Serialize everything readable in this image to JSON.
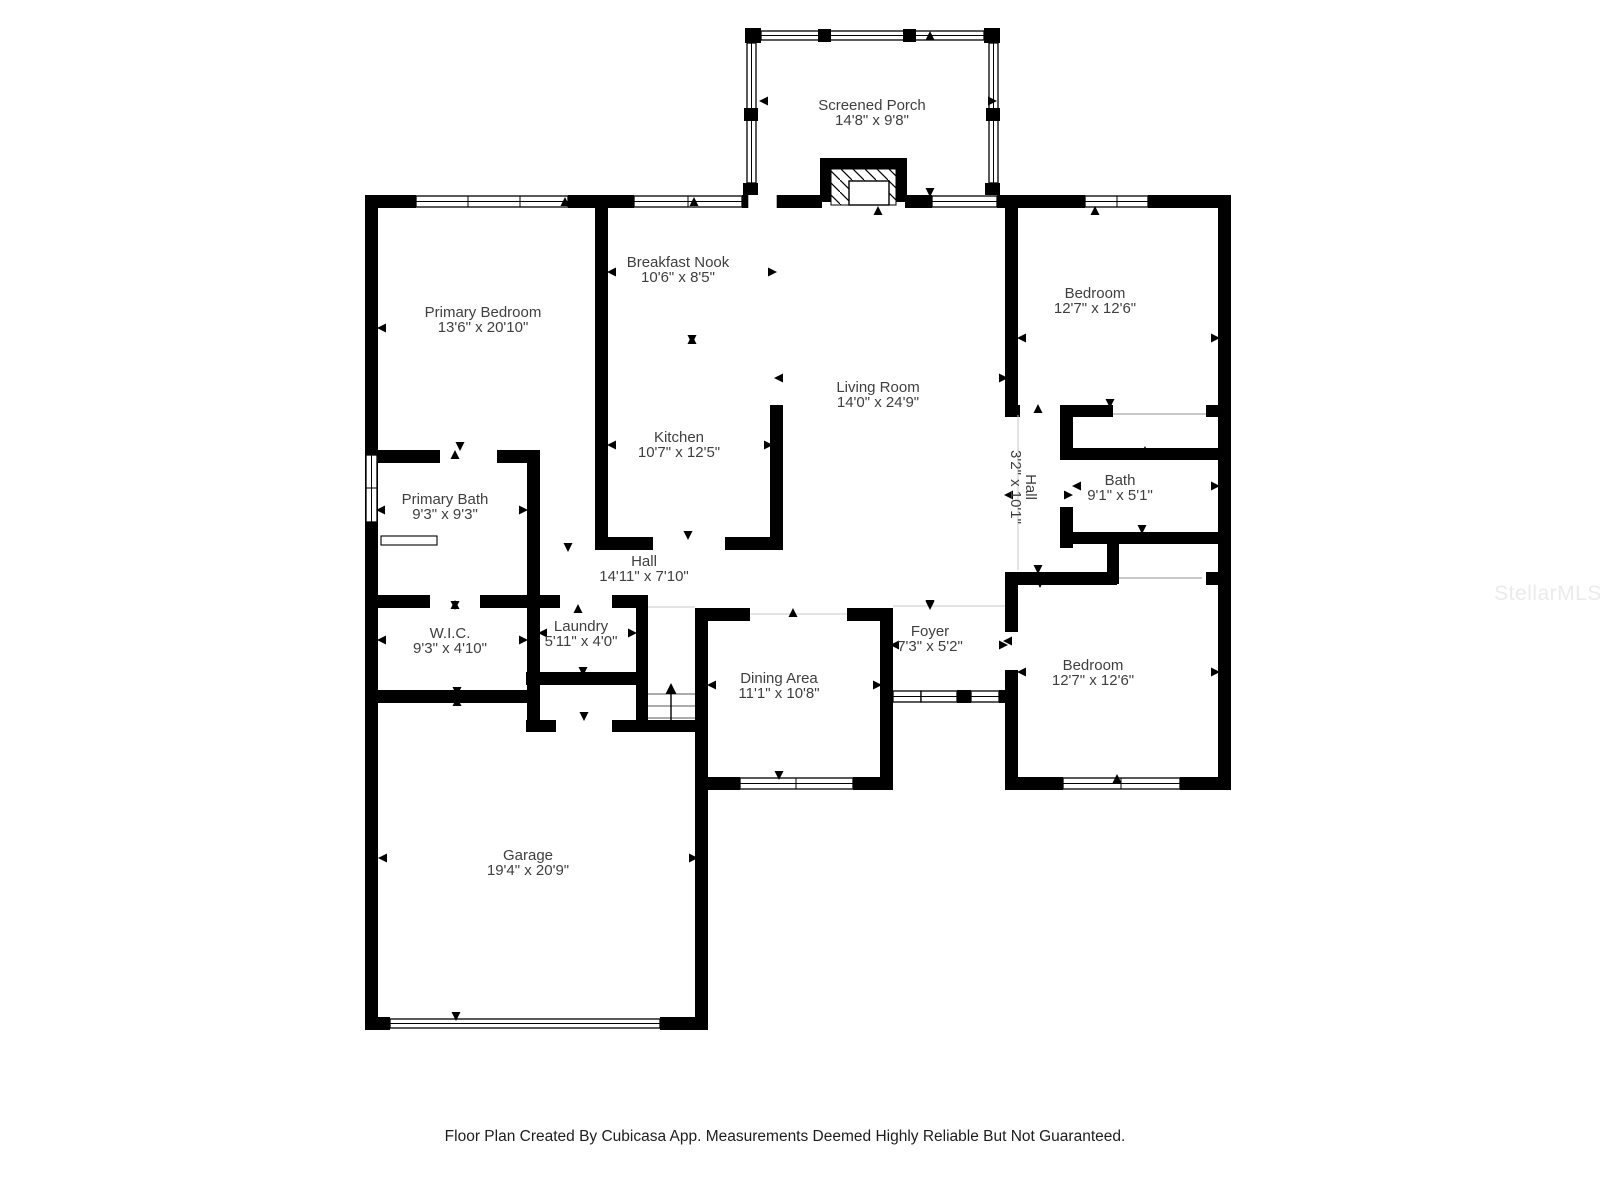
{
  "plan": {
    "rooms": [
      {
        "id": "screened-porch",
        "name": "Screened Porch",
        "dims": "14'8\" x 9'8\""
      },
      {
        "id": "primary-bedroom",
        "name": "Primary Bedroom",
        "dims": "13'6\" x 20'10\""
      },
      {
        "id": "breakfast-nook",
        "name": "Breakfast Nook",
        "dims": "10'6\" x 8'5\""
      },
      {
        "id": "living-room",
        "name": "Living Room",
        "dims": "14'0\" x 24'9\""
      },
      {
        "id": "bedroom-top",
        "name": "Bedroom",
        "dims": "12'7\" x 12'6\""
      },
      {
        "id": "kitchen",
        "name": "Kitchen",
        "dims": "10'7\" x 12'5\""
      },
      {
        "id": "primary-bath",
        "name": "Primary Bath",
        "dims": "9'3\" x 9'3\""
      },
      {
        "id": "hall-vertical",
        "name": "Hall",
        "dims": "3'2\" x 10'1\""
      },
      {
        "id": "bath",
        "name": "Bath",
        "dims": "9'1\" x 5'1\""
      },
      {
        "id": "hall-horizontal",
        "name": "Hall",
        "dims": "14'11\" x 7'10\""
      },
      {
        "id": "wic",
        "name": "W.I.C.",
        "dims": "9'3\" x 4'10\""
      },
      {
        "id": "laundry",
        "name": "Laundry",
        "dims": "5'11\" x 4'0\""
      },
      {
        "id": "foyer",
        "name": "Foyer",
        "dims": "7'3\" x 5'2\""
      },
      {
        "id": "dining-area",
        "name": "Dining Area",
        "dims": "11'1\" x 10'8\""
      },
      {
        "id": "bedroom-bottom",
        "name": "Bedroom",
        "dims": "12'7\" x 12'6\""
      },
      {
        "id": "garage",
        "name": "Garage",
        "dims": "19'4\" x 20'9\""
      }
    ],
    "footer": "Floor Plan Created By Cubicasa App. Measurements Deemed Highly Reliable But Not Guaranteed.",
    "watermark": "StellarMLS",
    "colors": {
      "wall": "#000000",
      "label": "#3f3f3f",
      "background": "#ffffff",
      "watermark": "#ebebeb"
    }
  }
}
